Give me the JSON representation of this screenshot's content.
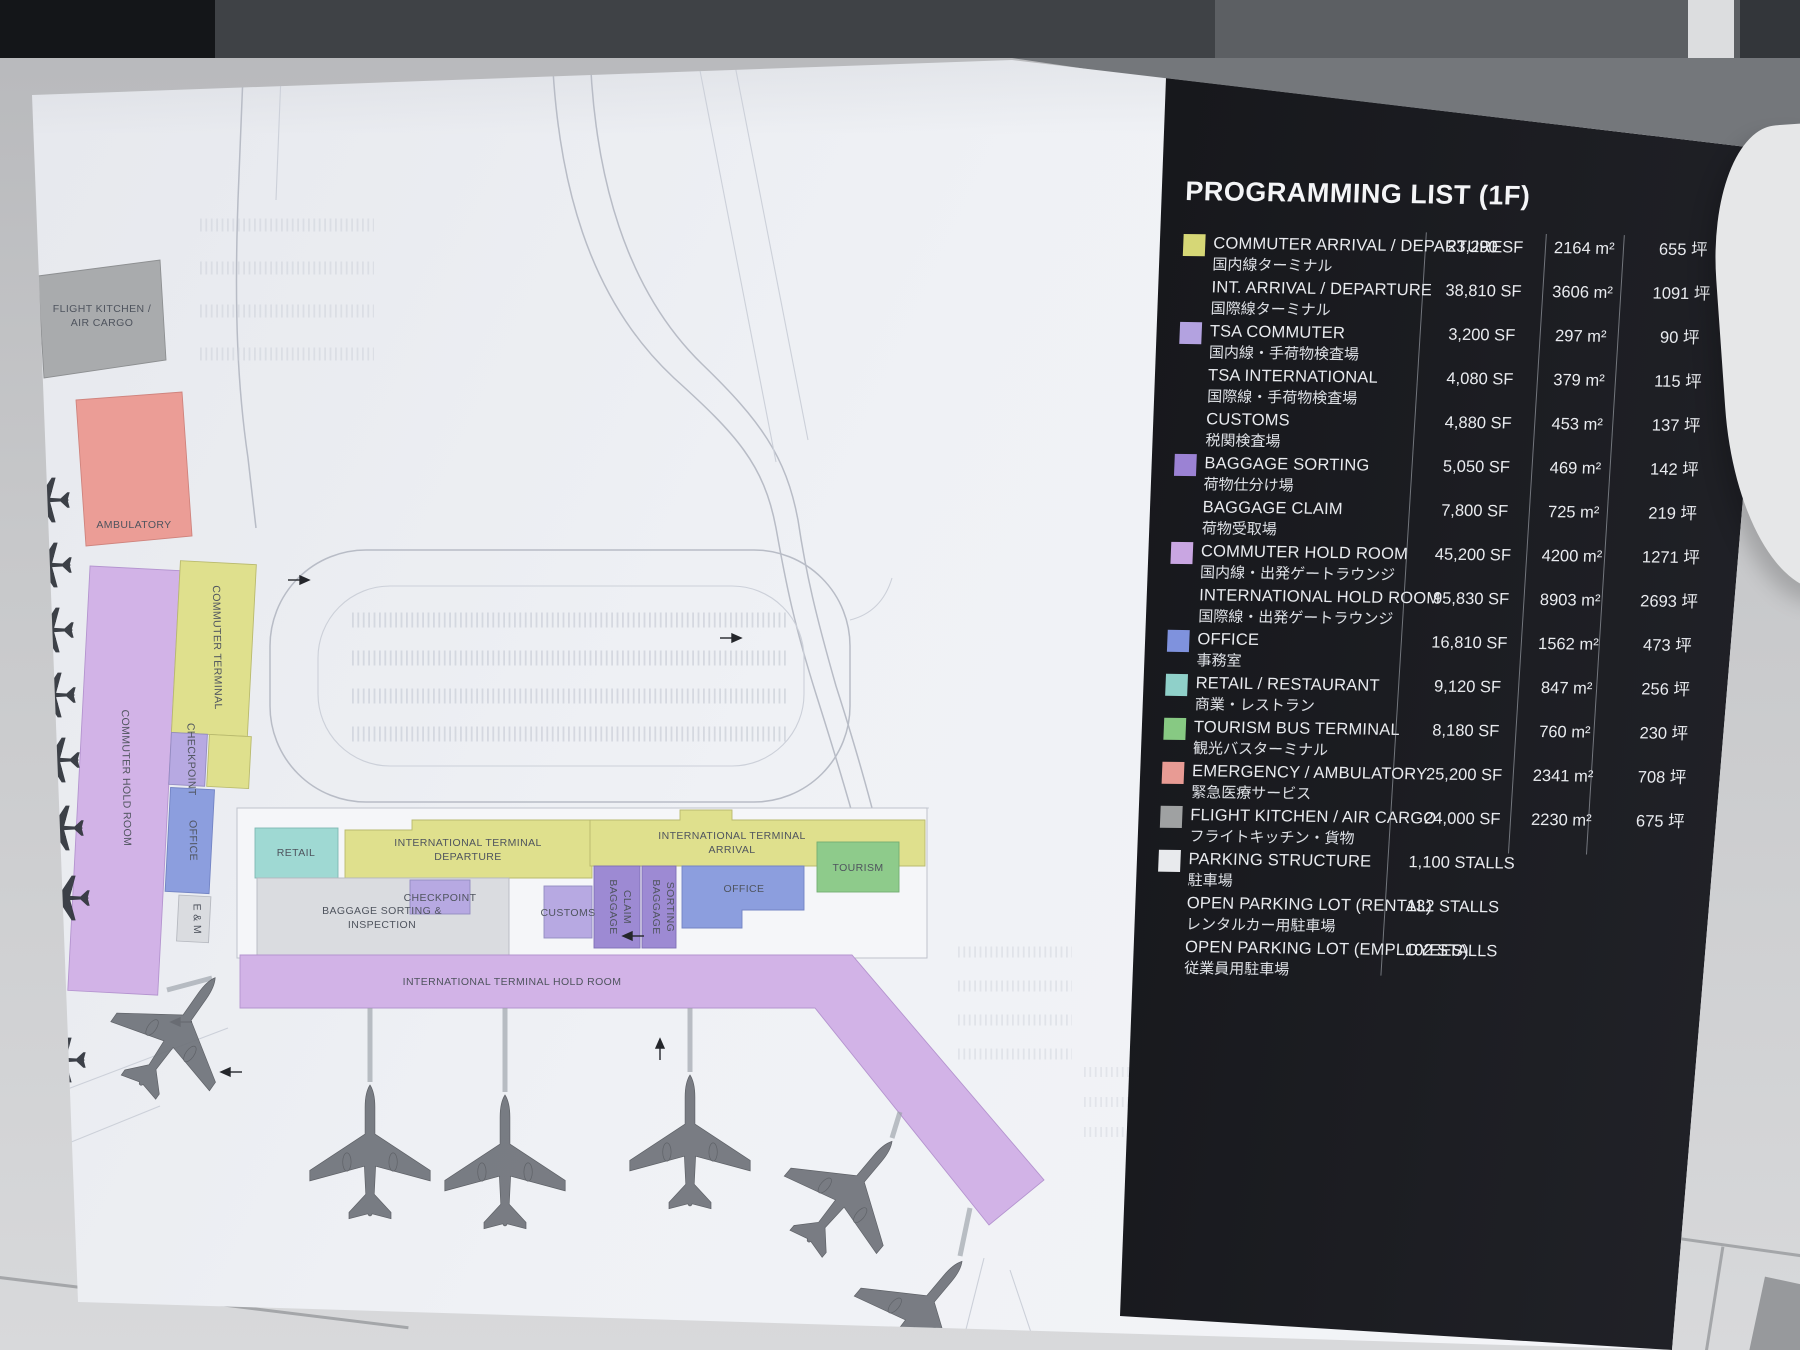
{
  "board": {
    "legend": {
      "title": "PROGRAMMING LIST (1F)",
      "rows": [
        {
          "swatch": "#d6d776",
          "en": "COMMUTER ARRIVAL / DEPARTURE",
          "jp": "国内線ターミナル",
          "sf": "23,290 SF",
          "m2": "2164 m²",
          "tsubo": "655 坪"
        },
        {
          "swatch": "",
          "en": "INT. ARRIVAL / DEPARTURE",
          "jp": "国際線ターミナル",
          "sf": "38,810 SF",
          "m2": "3606 m²",
          "tsubo": "1091 坪"
        },
        {
          "swatch": "#b3a2e0",
          "en": "TSA COMMUTER",
          "jp": "国内線・手荷物検査場",
          "sf": "3,200 SF",
          "m2": "297 m²",
          "tsubo": "90 坪"
        },
        {
          "swatch": "",
          "en": "TSA INTERNATIONAL",
          "jp": "国際線・手荷物検査場",
          "sf": "4,080 SF",
          "m2": "379 m²",
          "tsubo": "115 坪"
        },
        {
          "swatch": "",
          "en": "CUSTOMS",
          "jp": "税関検査場",
          "sf": "4,880 SF",
          "m2": "453 m²",
          "tsubo": "137 坪"
        },
        {
          "swatch": "#9b82d4",
          "en": "BAGGAGE SORTING",
          "jp": "荷物仕分け場",
          "sf": "5,050 SF",
          "m2": "469 m²",
          "tsubo": "142 坪"
        },
        {
          "swatch": "",
          "en": "BAGGAGE CLAIM",
          "jp": "荷物受取場",
          "sf": "7,800 SF",
          "m2": "725 m²",
          "tsubo": "219 坪"
        },
        {
          "swatch": "#c9a6e2",
          "en": "COMMUTER HOLD ROOM",
          "jp": "国内線・出発ゲートラウンジ",
          "sf": "45,200 SF",
          "m2": "4200 m²",
          "tsubo": "1271 坪"
        },
        {
          "swatch": "",
          "en": "INTERNATIONAL HOLD ROOM",
          "jp": "国際線・出発ゲートラウンジ",
          "sf": "95,830 SF",
          "m2": "8903 m²",
          "tsubo": "2693 坪"
        },
        {
          "swatch": "#7f92dd",
          "en": "OFFICE",
          "jp": "事務室",
          "sf": "16,810 SF",
          "m2": "1562 m²",
          "tsubo": "473 坪"
        },
        {
          "swatch": "#8fd0c9",
          "en": "RETAIL / RESTAURANT",
          "jp": "商業・レストラン",
          "sf": "9,120 SF",
          "m2": "847 m²",
          "tsubo": "256 坪"
        },
        {
          "swatch": "#87c983",
          "en": "TOURISM BUS TERMINAL",
          "jp": "観光バスターミナル",
          "sf": "8,180 SF",
          "m2": "760 m²",
          "tsubo": "230 坪"
        },
        {
          "swatch": "#e89b94",
          "en": "EMERGENCY / AMBULATORY",
          "jp": "緊急医療サービス",
          "sf": "25,200 SF",
          "m2": "2341 m²",
          "tsubo": "708 坪"
        },
        {
          "swatch": "#9fa1a2",
          "en": "FLIGHT KITCHEN / AIR CARGO",
          "jp": "フライトキッチン・貨物",
          "sf": "24,000 SF",
          "m2": "2230 m²",
          "tsubo": "675 坪"
        },
        {
          "swatch": "#e8eaed",
          "en": "PARKING STRUCTURE",
          "jp": "駐車場",
          "sf": "1,100 STALLS",
          "m2": "",
          "tsubo": ""
        },
        {
          "swatch": "",
          "en": "OPEN PARKING LOT (RENTAL)",
          "jp": "レンタルカー用駐車場",
          "sf": "132 STALLS",
          "m2": "",
          "tsubo": ""
        },
        {
          "swatch": "",
          "en": "OPEN PARKING LOT (EMPLOYEES)",
          "jp": "従業員用駐車場",
          "sf": "102 STALLS",
          "m2": "",
          "tsubo": ""
        }
      ]
    },
    "plan": {
      "labels": {
        "flight_kitchen_1": "FLIGHT KITCHEN /",
        "flight_kitchen_2": "AIR CARGO",
        "ambulatory": "AMBULATORY",
        "commuter_terminal": "COMMUTER TERMINAL",
        "commuter_hold_room": "COMMUTER HOLD ROOM",
        "checkpoint_left": "CHECKPOINT",
        "office_left": "OFFICE",
        "em": "E & M",
        "retail": "RETAIL",
        "intl_dep_1": "INTERNATIONAL TERMINAL",
        "intl_dep_2": "DEPARTURE",
        "checkpoint_mid": "CHECKPOINT",
        "baggage_sort_insp_1": "BAGGAGE SORTING &",
        "baggage_sort_insp_2": "INSPECTION",
        "customs": "CUSTOMS",
        "baggage_claim_1": "BAGGAGE",
        "baggage_claim_2": "CLAIM",
        "baggage_sorting_1": "BAGGAGE",
        "baggage_sorting_2": "SORTING",
        "intl_arr_1": "INTERNATIONAL TERMINAL",
        "intl_arr_2": "ARRIVAL",
        "office_mid": "OFFICE",
        "tourism": "TOURISM",
        "intl_hold_room": "INTERNATIONAL TERMINAL HOLD ROOM"
      },
      "planes": [
        {
          "x": 143,
          "y": 975,
          "rot": 35,
          "scale": 0.7,
          "kind": "jet"
        },
        {
          "x": 338,
          "y": 1095,
          "rot": 0,
          "scale": 0.7,
          "kind": "jet"
        },
        {
          "x": 473,
          "y": 1105,
          "rot": 0,
          "scale": 0.7,
          "kind": "jet"
        },
        {
          "x": 658,
          "y": 1085,
          "rot": 0,
          "scale": 0.7,
          "kind": "jet"
        },
        {
          "x": 815,
          "y": 1135,
          "rot": 40,
          "scale": 0.7,
          "kind": "jet"
        },
        {
          "x": 885,
          "y": 1255,
          "rot": 40,
          "scale": 0.7,
          "kind": "jet"
        },
        {
          "x": 14,
          "y": 440,
          "rot": -90,
          "scale": 0.26,
          "kind": "commuter"
        },
        {
          "x": 16,
          "y": 505,
          "rot": -90,
          "scale": 0.26,
          "kind": "commuter"
        },
        {
          "x": 18,
          "y": 570,
          "rot": -90,
          "scale": 0.26,
          "kind": "commuter"
        },
        {
          "x": 20,
          "y": 635,
          "rot": -90,
          "scale": 0.26,
          "kind": "commuter"
        },
        {
          "x": 24,
          "y": 700,
          "rot": -90,
          "scale": 0.26,
          "kind": "commuter"
        },
        {
          "x": 28,
          "y": 768,
          "rot": -90,
          "scale": 0.26,
          "kind": "commuter"
        },
        {
          "x": 34,
          "y": 838,
          "rot": -90,
          "scale": 0.26,
          "kind": "commuter"
        },
        {
          "x": 30,
          "y": 1000,
          "rot": -90,
          "scale": 0.26,
          "kind": "commuter"
        }
      ],
      "colors": {
        "terminal_yellow": "#dfe08d",
        "tsa_lavender": "#b7a9e2",
        "baggage_purple": "#9d8ad3",
        "hold_room_light_purple": "#d2b3e7",
        "office_blue": "#8c9ede",
        "retail_teal": "#9fd9d3",
        "tourism_green": "#8ecb8b",
        "emergency_salmon": "#eb9d96",
        "cargo_gray": "#a9abad",
        "parking_white": "#eef0f3",
        "panel_bg": "#16171b",
        "paper": "#eff1f5"
      }
    }
  }
}
